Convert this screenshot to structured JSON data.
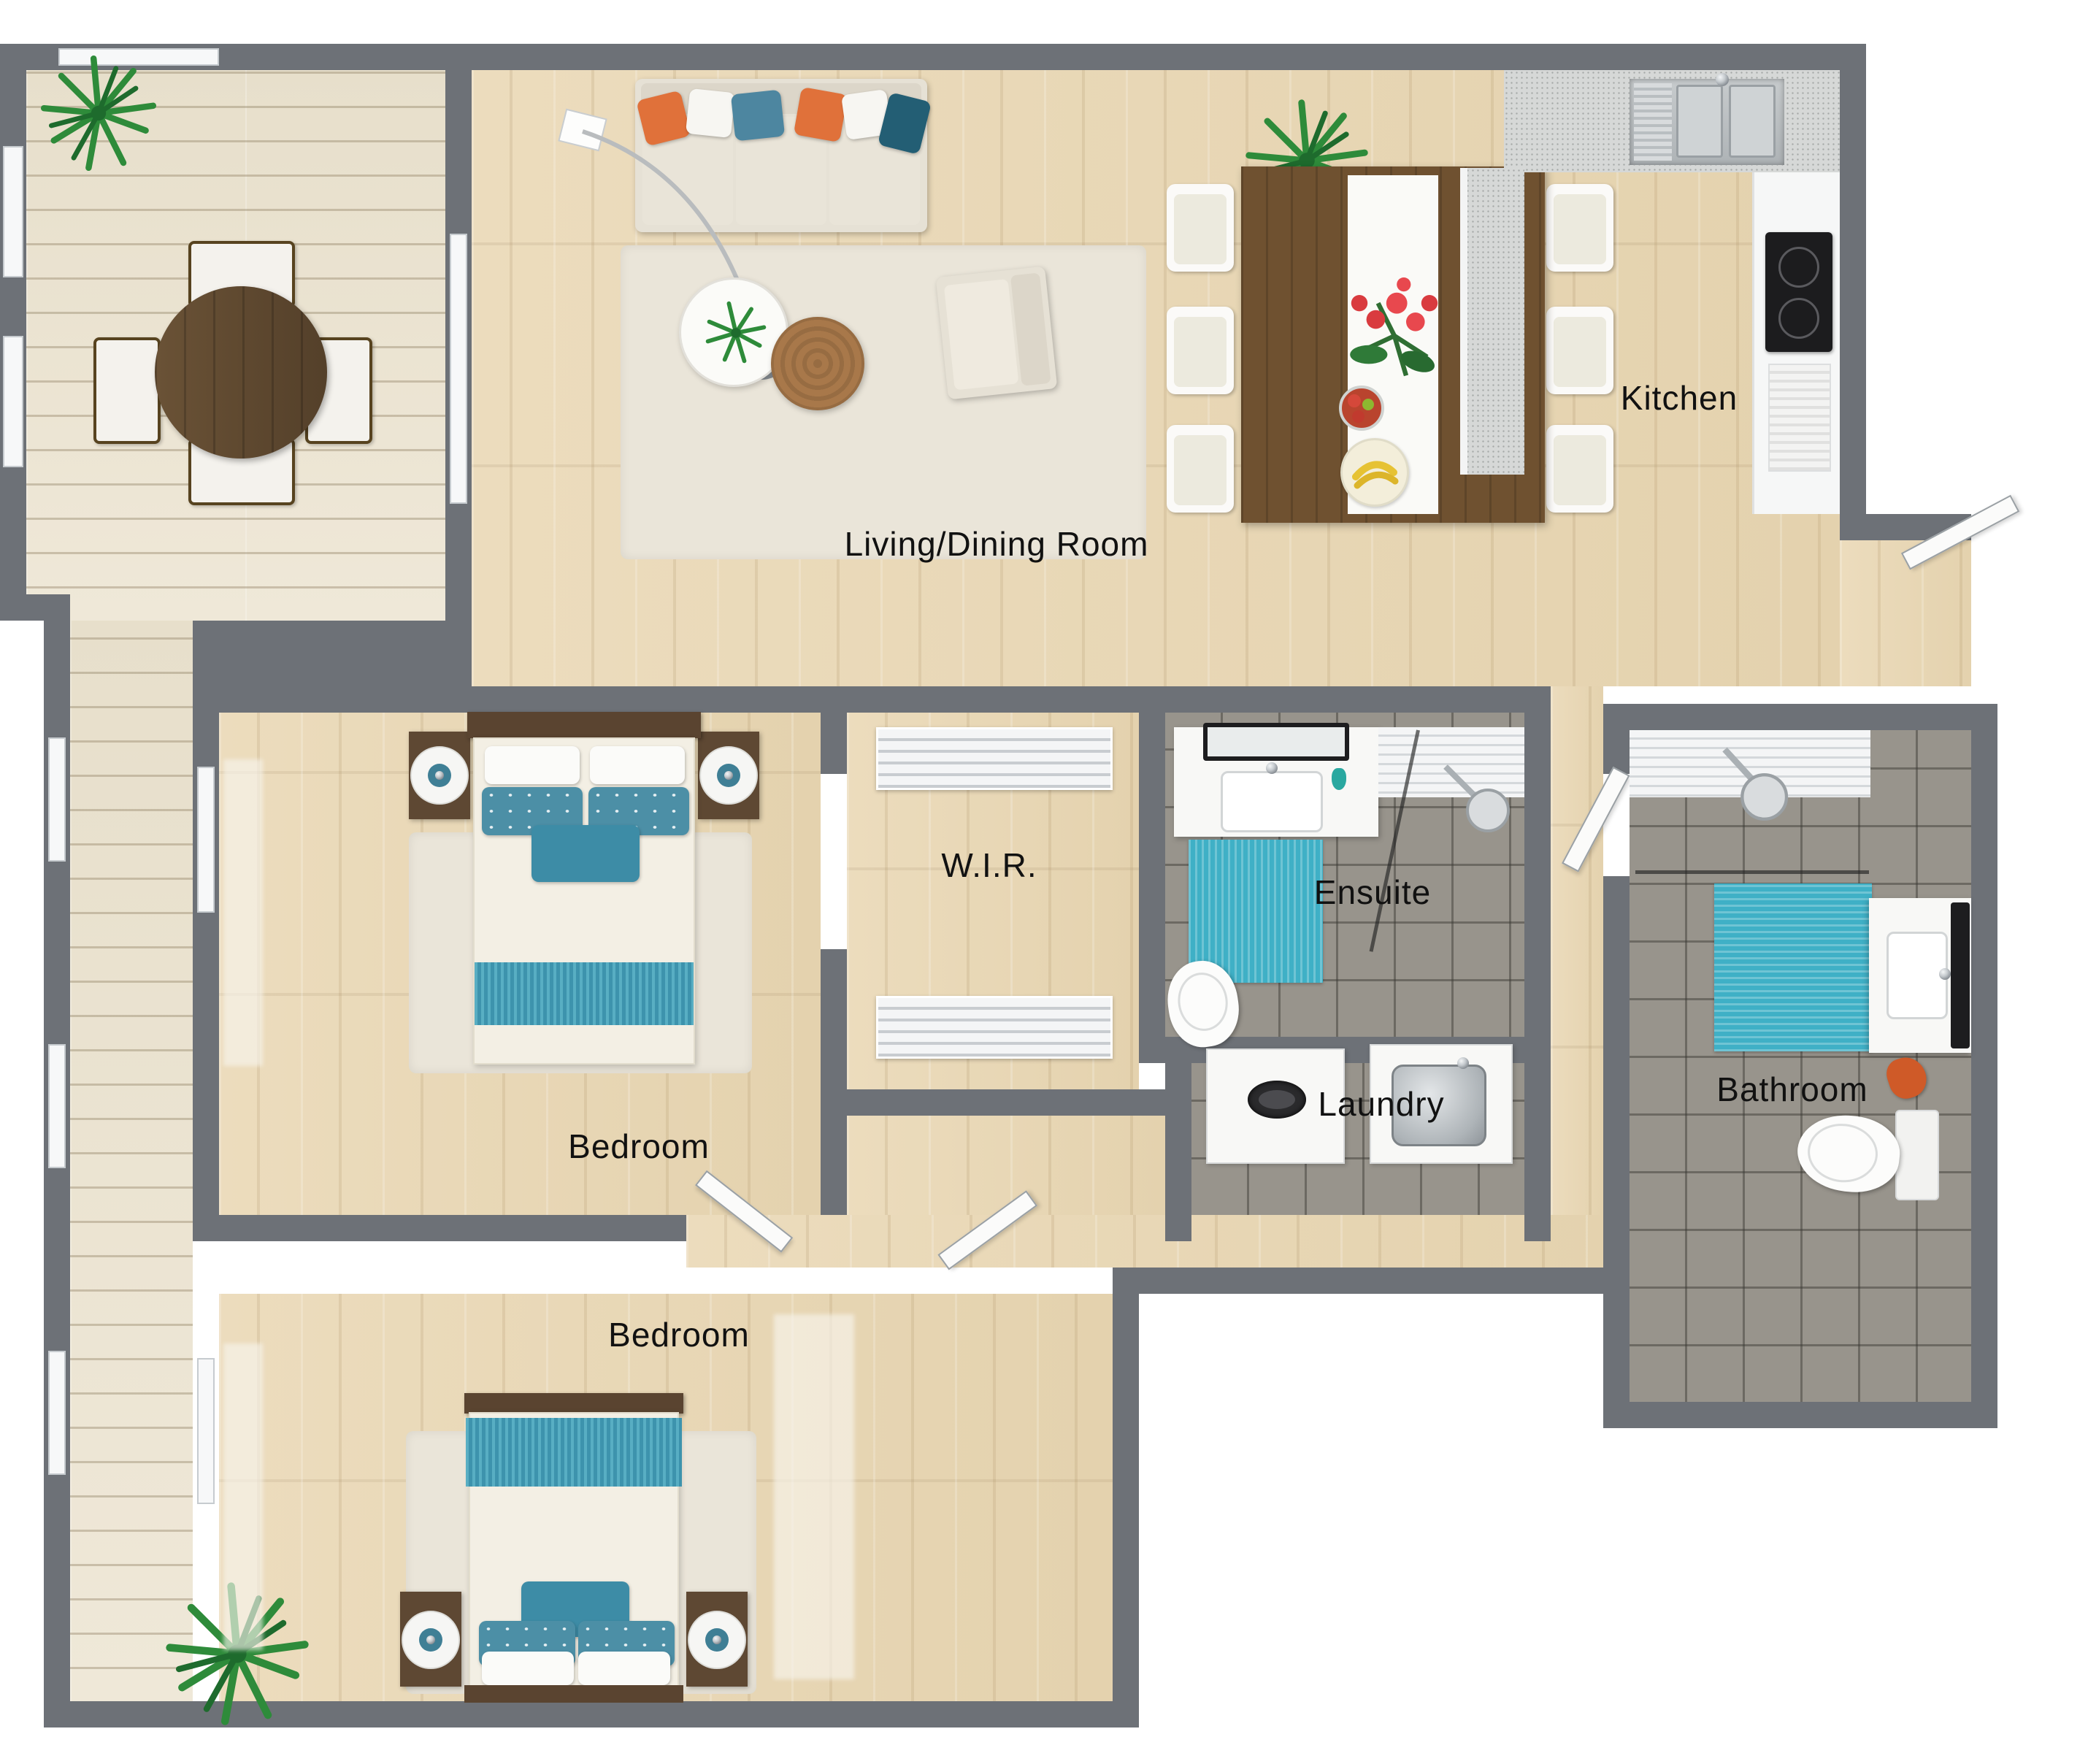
{
  "floorplan": {
    "rooms": {
      "living": {
        "label": "Living/Dining Room"
      },
      "kitchen": {
        "label": "Kitchen"
      },
      "wir": {
        "label": "W.I.R."
      },
      "ensuite": {
        "label": "Ensuite"
      },
      "laundry": {
        "label": "Laundry"
      },
      "bathroom": {
        "label": "Bathroom"
      },
      "bedroom1": {
        "label": "Bedroom"
      },
      "bedroom2": {
        "label": "Bedroom"
      }
    },
    "colors": {
      "wall": "#6d7177",
      "wood_floor": "#e8d6b2",
      "deck_floor": "#ece4d2",
      "tile_floor": "#98948c",
      "counter_speckle": "#d6d8d7",
      "accent_teal": "#3fb0c6",
      "accent_steel_blue": "#4d86a0",
      "accent_deep_teal": "#235e74",
      "accent_orange": "#e0713a",
      "dark_wood": "#5e4833",
      "label_text": "#111111"
    },
    "icons": {
      "plant": "plant-icon",
      "shower_head": "shower-head-icon",
      "sink": "sink-icon",
      "cooktop": "cooktop-icon",
      "toilet": "toilet-icon",
      "washer": "washer-icon",
      "lamp": "arc-floor-lamp-icon"
    }
  }
}
